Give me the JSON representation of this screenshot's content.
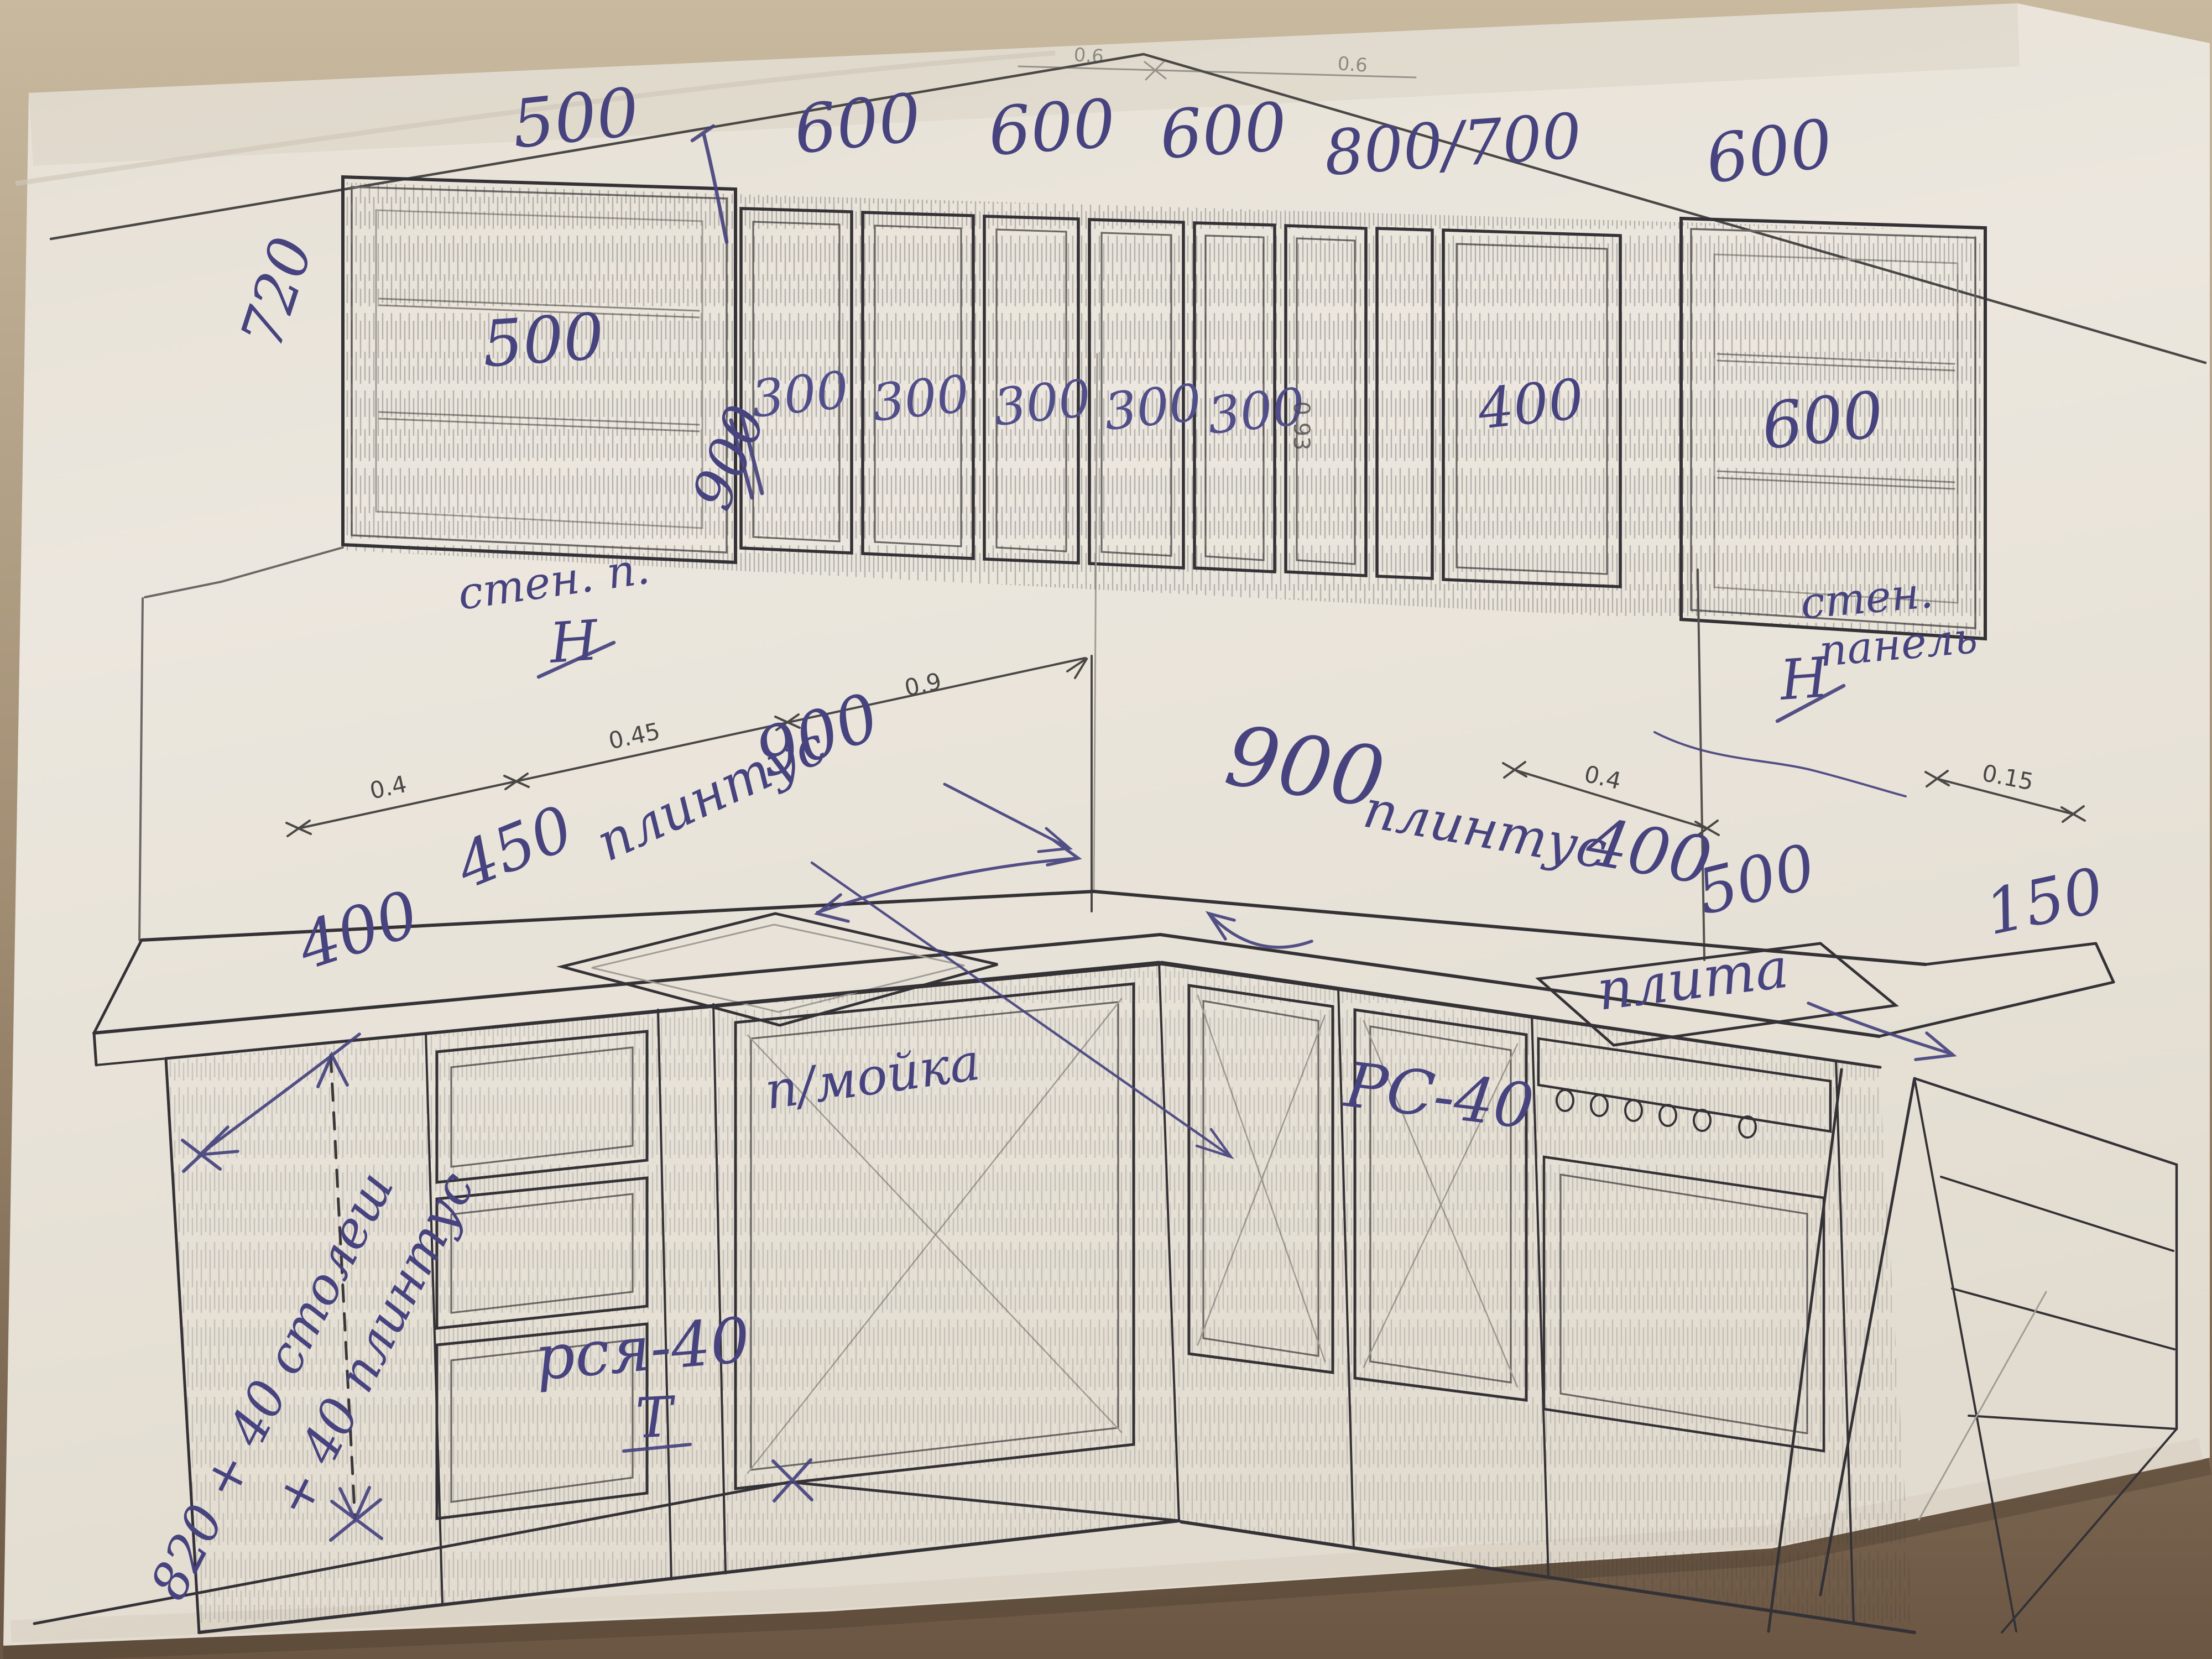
{
  "upper": {
    "widths": [
      "500",
      "600",
      "600",
      "600",
      "800/700",
      "600"
    ],
    "side_height": "720",
    "door_labels": {
      "glass_left": "500",
      "depth_rotated": "900",
      "narrow": [
        "300",
        "300",
        "300",
        "300",
        "300"
      ],
      "corner_door": "400",
      "glass_right": "600"
    },
    "printed_height": "0.93"
  },
  "wall": {
    "left_note": "стен. п.",
    "left_symbol": "Н",
    "right_note_line1": "стен.",
    "right_note_line2": "панель",
    "right_symbol": "Н"
  },
  "dims": {
    "top": [
      "0.6",
      "0.6"
    ],
    "left_chain": [
      "0.4",
      "0.45",
      "0.9"
    ],
    "right_wall": "0.4",
    "right_end": "0.15"
  },
  "counter": {
    "left_depth": "400",
    "left_a": "450",
    "left_word": "плинтус",
    "left_b": "900",
    "right_a": "900",
    "right_word": "плинтус",
    "right_b": "400",
    "right_len": "500",
    "right_overhang": "150",
    "stove": "плита"
  },
  "base": {
    "height_line1": "820 + 40 столеш",
    "height_line2": "+ 40 плинтус",
    "drawer_unit": "рся-40",
    "drawer_mark": "Т",
    "sink_cabinet": "п/мойка",
    "cabinet_code": "РС-40"
  },
  "ink_color": "#46437f",
  "print_color": "#343236",
  "paper_color": "#eae5dc"
}
